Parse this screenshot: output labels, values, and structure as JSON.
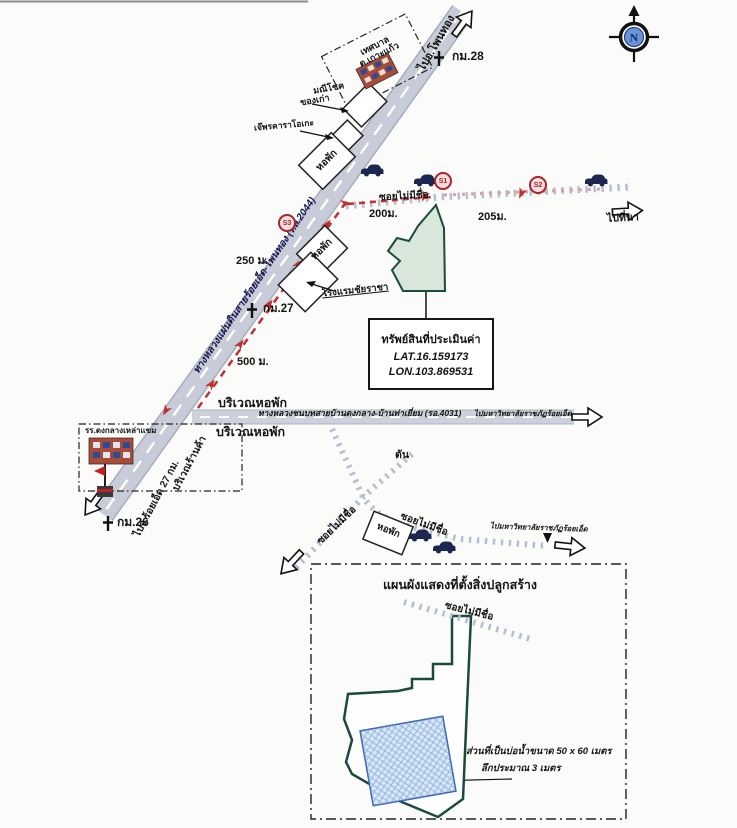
{
  "compass": {
    "north_label": "N"
  },
  "highway": {
    "name_label": "ทางหลวงแผ่นดินสายร้อยเอ็ด-โพนทอง (ทล.2044)",
    "direction_north": "ไปอ.โพนทอง",
    "km_28": "กม.28",
    "km_27": "กม.27",
    "km_26": "กม.26",
    "direction_south": "ไปจ.ร้อยเอ็ด 27 กม.",
    "shop_area_label": "บริเวณร้านค้า",
    "distance_250": "250 ม.",
    "distance_500": "500 ม."
  },
  "landmarks_top": {
    "municipality_line1": "เทศบาล",
    "municipality_line2": "ต.เกาะแก้ว",
    "antique_shop_line1": "มณีโชค",
    "antique_shop_line2": "ของเก่า",
    "karaoke": "เจ๊พรคาราโอเกะ",
    "dorm_upper": "หอพัก",
    "dorm_lower": "หอพัก",
    "hotel": "โรงแรมชัยราชา"
  },
  "soi_access": {
    "name": "ซอยไม่มีชื่อ",
    "distance_segment1": "200ม.",
    "distance_segment2": "205ม.",
    "direction_east": "ไปที่นา",
    "marker_s1": "S1",
    "marker_s2": "S2",
    "marker_s3": "S3"
  },
  "property": {
    "title": "ทรัพย์สินที่ประเมินค่า",
    "lat": "LAT.16.159173",
    "lon": "LON.103.869531"
  },
  "rural_road": {
    "name_label": "ทางหลวงชนบทสายบ้านดงกลาง-บ้านท่าเยี่ยม (รอ.4031)",
    "direction_east": "ไปมหาวิทยาลัยราชภัฏร้อยเอ็ด",
    "dorm_area_above": "บริเวณหอพัก",
    "dorm_area_below": "บริเวณหอพัก"
  },
  "school": {
    "name": "รร.ดงกลางเหล่าแขม"
  },
  "lower_area": {
    "dead_end": "ตัน",
    "soi_southwest": "ซอยไม่มีชื่อ",
    "soi_east": "ซอยไม่มีชื่อ",
    "dorm": "หอพัก",
    "direction_university": "ไปมหาวิทยาลัยราชภัฏร้อยเอ็ด"
  },
  "site_plan": {
    "title": "แผนผังแสดงที่ตั้งสิ่งปลูกสร้าง",
    "soi": "ซอยไม่มีชื่อ",
    "pond_note_line1": "ส่วนที่เป็นบ่อน้ำขนาด 50 x 60 เมตร",
    "pond_note_line2": "ลึกประมาณ 3 เมตร"
  },
  "colors": {
    "road_fill": "#c7ccd8",
    "route_red": "#c03030",
    "property_fill": "#d9e7da",
    "property_outline": "#1c4a3c",
    "pond_fill": "#d8e6f7",
    "pond_outline": "#3a6ab8",
    "marker_red": "#a8242e"
  }
}
